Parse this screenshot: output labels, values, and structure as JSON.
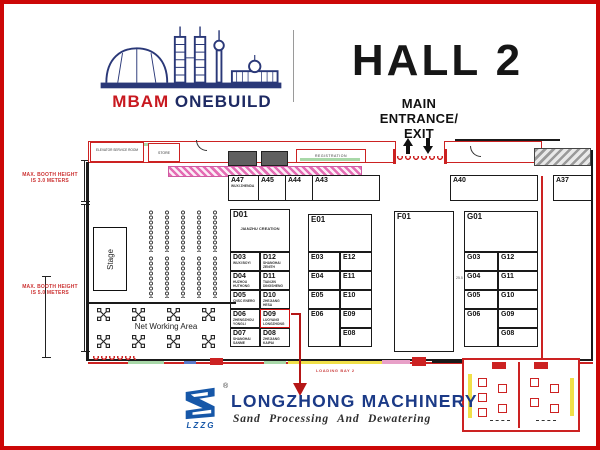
{
  "header": {
    "brand_red": "MBAM",
    "brand_navy": "ONEBUILD",
    "hall": "HALL 2",
    "entrance_lines": [
      "MAIN",
      "ENTRANCE/",
      "EXIT"
    ]
  },
  "plan": {
    "height_label_top": "MAX. BOOTH HEIGHT IS 3.0 METERS",
    "height_label_bottom": "MAX. BOOTH HEIGHT IS 5.0 METERS",
    "rooms": {
      "elevator": "ELEVATOR SERVICE ROOM",
      "store": "STORE",
      "registration": "REGISTRATION"
    },
    "stage": "Stage",
    "networking": "Net Working Area",
    "loading_bay": "LOADING BAY 2",
    "dim_f01": "25.5",
    "booths_top": [
      {
        "id": "A47",
        "company": "WUXI ZHENDA"
      },
      {
        "id": "A45",
        "company": ""
      },
      {
        "id": "A44",
        "company": ""
      },
      {
        "id": "A43",
        "company": ""
      },
      {
        "id": "A40",
        "company": ""
      },
      {
        "id": "A37",
        "company": ""
      }
    ],
    "d01": {
      "id": "D01",
      "company": "JIANZHU CREATION"
    },
    "d_cells": [
      {
        "id": "D03",
        "company": "WUXI BOYI"
      },
      {
        "id": "D12",
        "company": "SHANGHAI ZENITH"
      },
      {
        "id": "D04",
        "company": "HUZHOU HUTHONG"
      },
      {
        "id": "D11",
        "company": "TIANJIN DINGSHENG"
      },
      {
        "id": "D05",
        "company": "CNSC ENERG"
      },
      {
        "id": "D10",
        "company": "ZHEJIANG HESA"
      },
      {
        "id": "D06",
        "company": "ZHENGZHOU YONGLI"
      },
      {
        "id": "D09",
        "company": "LUOYANG LONGZHONG"
      },
      {
        "id": "D07",
        "company": "SHANGHAI SANME"
      },
      {
        "id": "D08",
        "company": "ZHEJIANG KAIPAI"
      }
    ],
    "e01": "E01",
    "e_cells": [
      "E03",
      "E12",
      "E04",
      "E11",
      "E05",
      "E10",
      "E06",
      "E09",
      "E08"
    ],
    "f01": "F01",
    "g01": "G01",
    "g_cells": [
      "G03",
      "G12",
      "G04",
      "G11",
      "G05",
      "G10",
      "G06",
      "G09",
      "G08"
    ]
  },
  "footer": {
    "logo_text": "LZZG",
    "reg": "®",
    "brand": "LONGZHONG MACHINERY",
    "tagline": "Sand Processing And Dewatering"
  },
  "colors": {
    "wall_red": "#cc2222",
    "brand_red": "#c8181f",
    "brand_navy": "#1e2a63",
    "lzzg_blue": "#1657a8",
    "highlight_red": "#cc1111",
    "hatch_pink": "#e56cb4",
    "loading_yellow": "#f0e049",
    "strip_green": "#a8d8a8"
  }
}
